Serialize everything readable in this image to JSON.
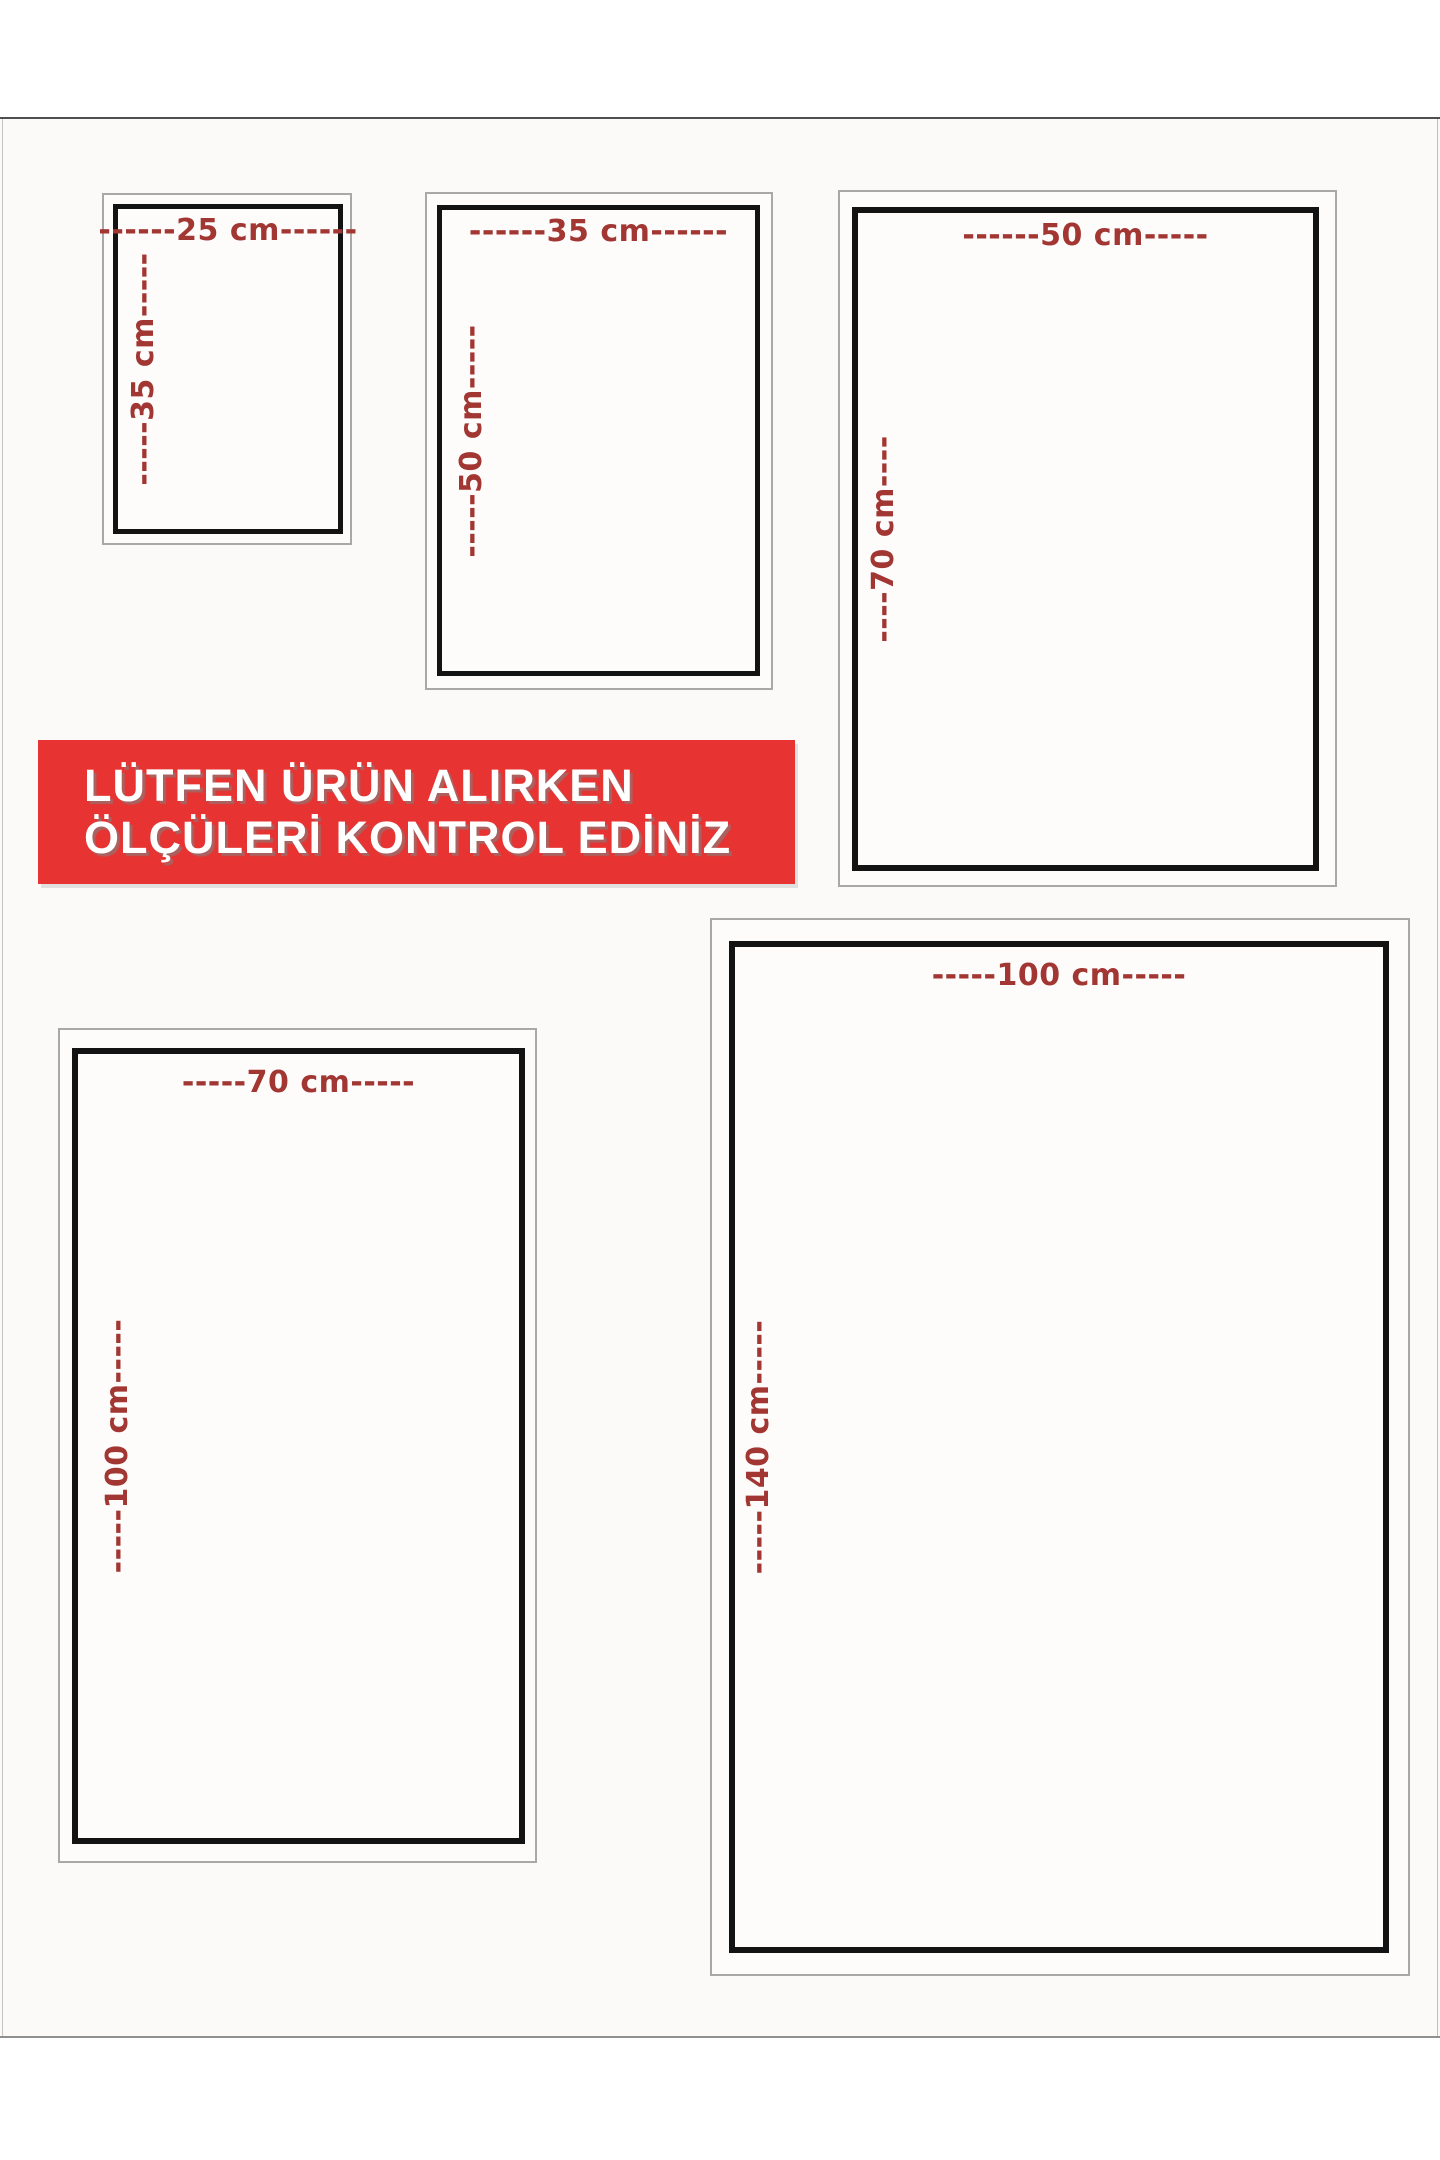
{
  "notice_banner": {
    "line1": "LÜTFEN ÜRÜN ALIRKEN",
    "line2": "ÖLÇÜLERİ KONTROL EDİNİZ",
    "background_color": "#e73331",
    "text_color": "#ffffff"
  },
  "sizes": [
    {
      "name": "25x35",
      "width_cm": 25,
      "height_cm": 35,
      "width_label": "------25 cm------",
      "height_label": "-----35 cm-----"
    },
    {
      "name": "35x50",
      "width_cm": 35,
      "height_cm": 50,
      "width_label": "------35 cm------",
      "height_label": "-----50 cm-----"
    },
    {
      "name": "50x70",
      "width_cm": 50,
      "height_cm": 70,
      "width_label": "------50 cm-----",
      "height_label": "----70 cm----"
    },
    {
      "name": "70x100",
      "width_cm": 70,
      "height_cm": 100,
      "width_label": "-----70 cm-----",
      "height_label": "-----100 cm-----"
    },
    {
      "name": "100x140",
      "width_cm": 100,
      "height_cm": 140,
      "width_label": "-----100 cm-----",
      "height_label": "-----140 cm-----"
    }
  ],
  "colors": {
    "dimension_text": "#a23632",
    "frame_black": "#131313",
    "frame_gray": "#a8a8a8",
    "canvas_background": "#fbfaf8"
  }
}
